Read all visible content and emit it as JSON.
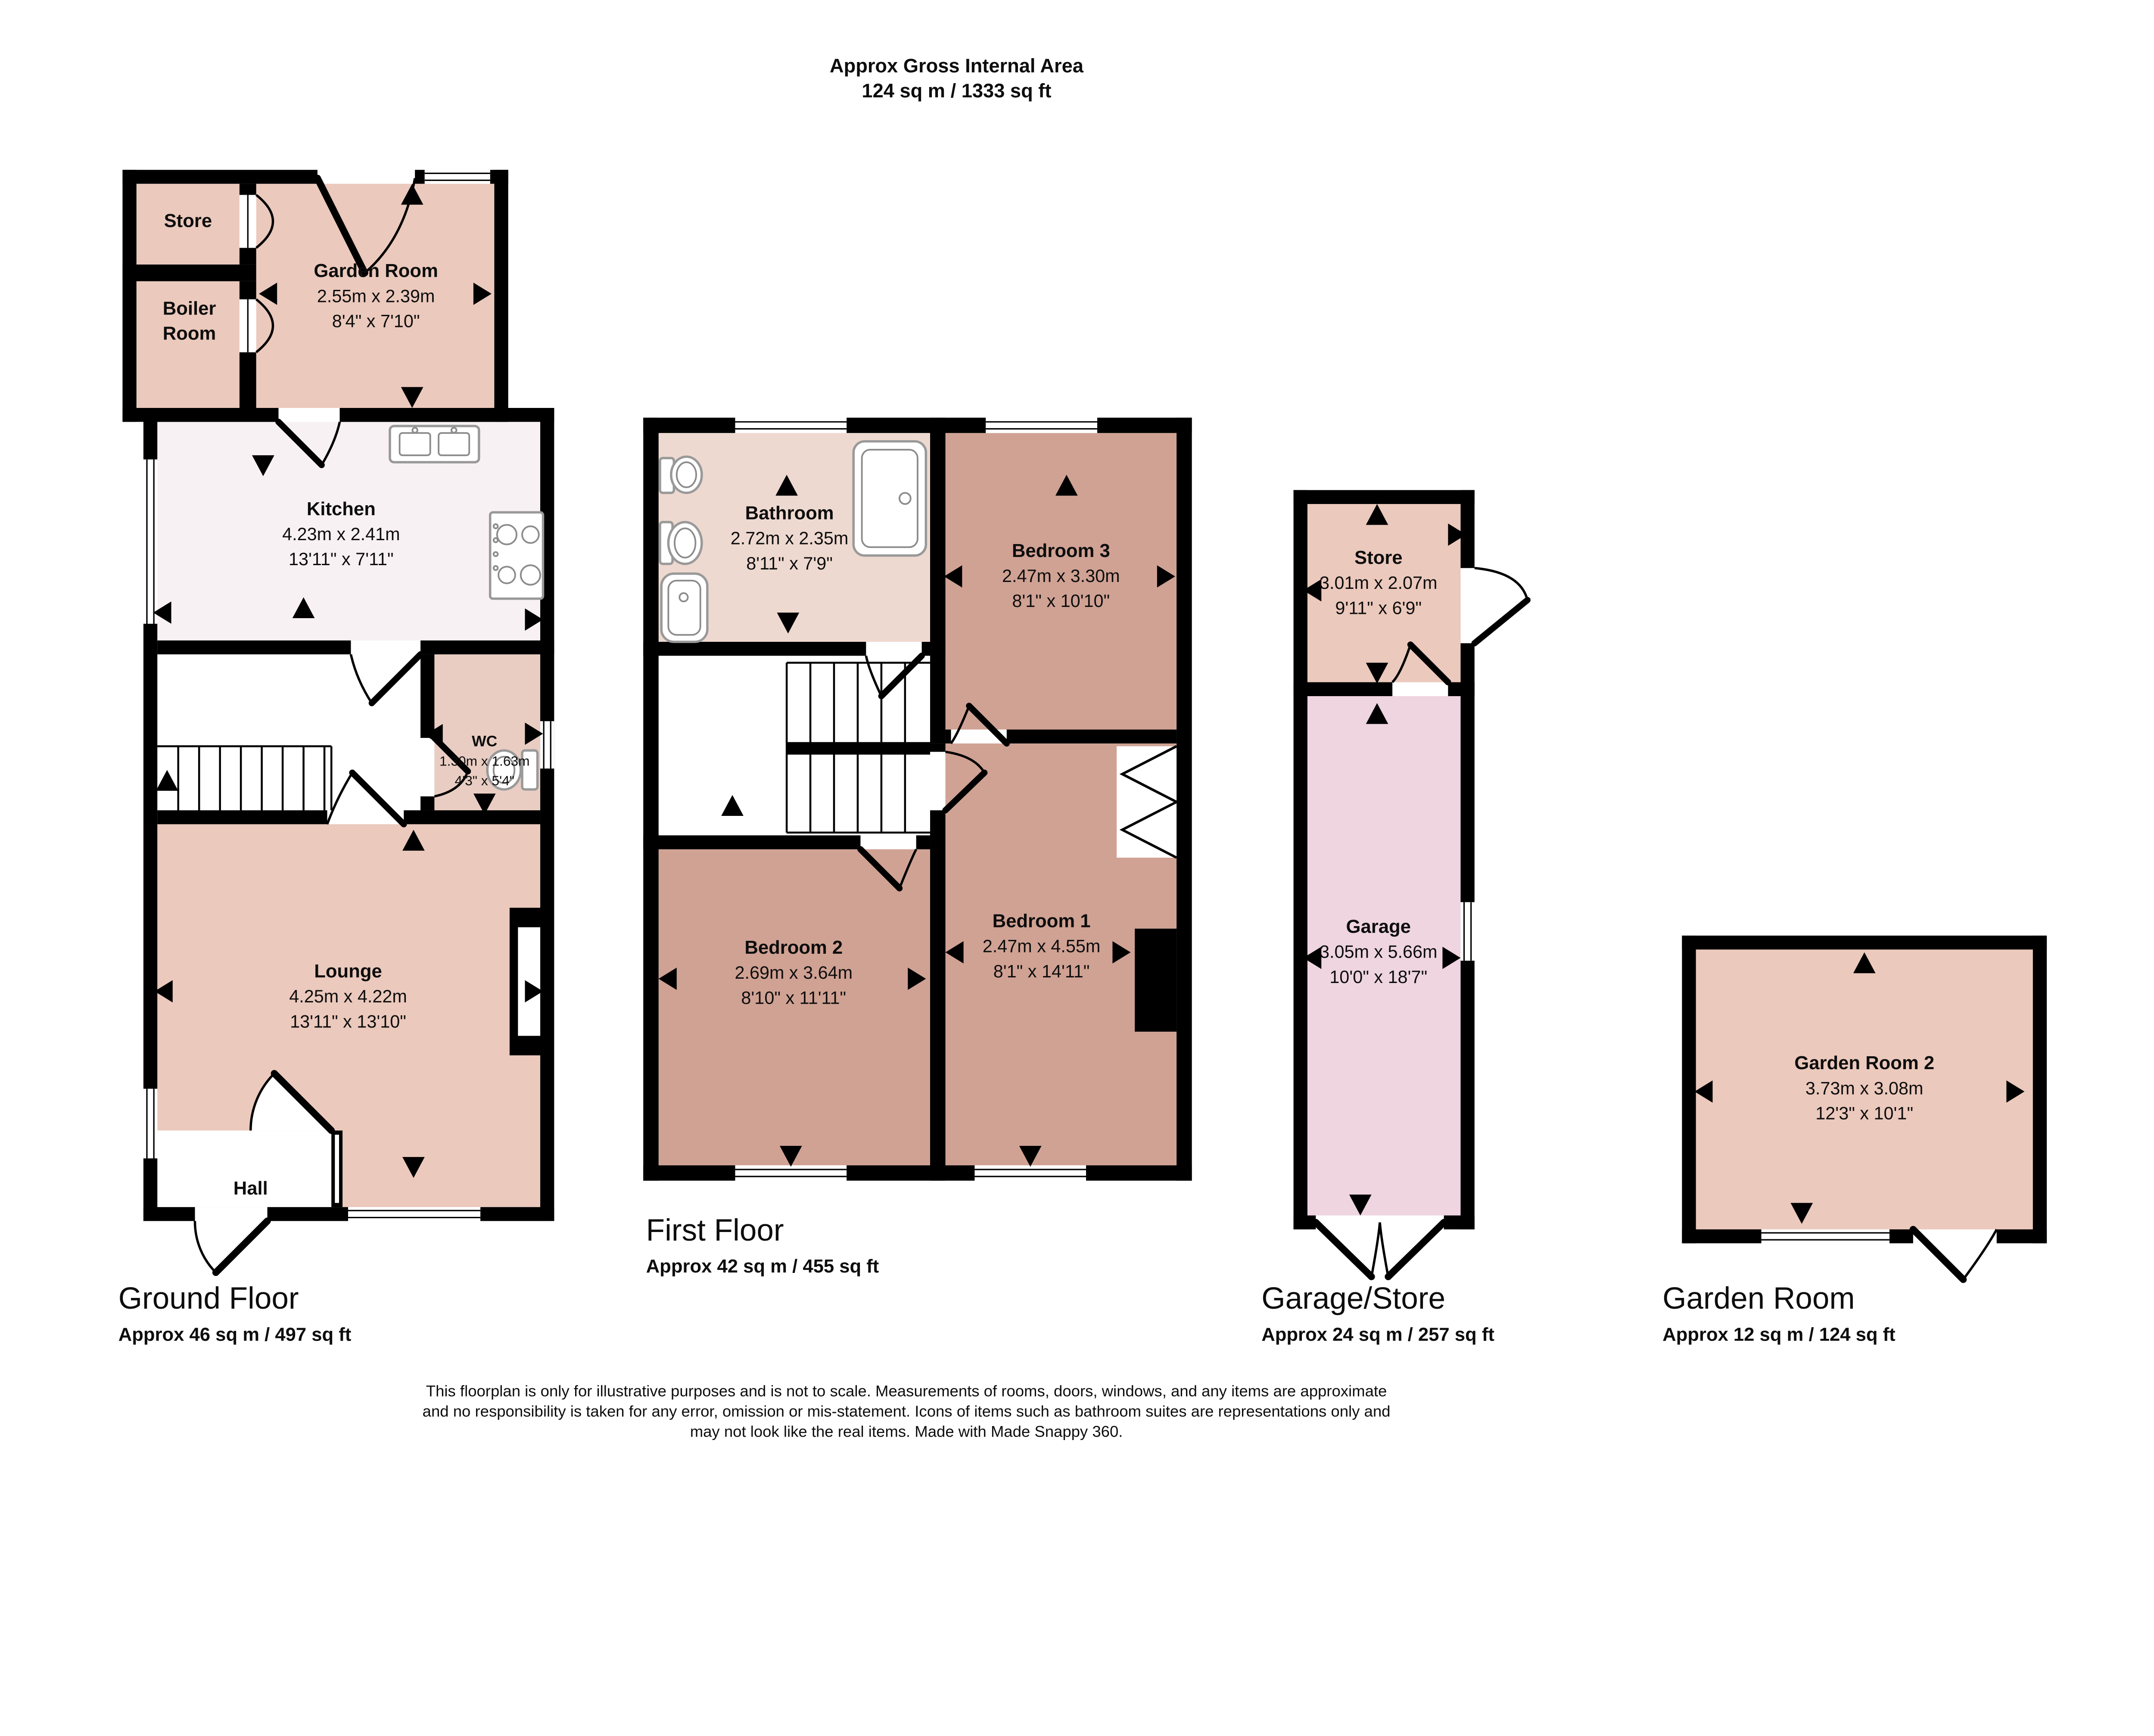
{
  "header": {
    "line1": "Approx Gross Internal Area",
    "line2": "124 sq m / 1333 sq ft"
  },
  "floors": {
    "ground": {
      "title": "Ground Floor",
      "area": "Approx 46 sq m / 497 sq ft",
      "rooms": {
        "store": {
          "name": "Store"
        },
        "boiler_room": {
          "line1": "Boiler",
          "line2": "Room"
        },
        "garden_room": {
          "name": "Garden Room",
          "metric": "2.55m x 2.39m",
          "imperial": "8'4\" x 7'10\""
        },
        "kitchen": {
          "name": "Kitchen",
          "metric": "4.23m x 2.41m",
          "imperial": "13'11\" x 7'11\""
        },
        "wc": {
          "name": "WC",
          "metric": "1.30m x 1.63m",
          "imperial": "4'3\" x 5'4\""
        },
        "lounge": {
          "name": "Lounge",
          "metric": "4.25m x 4.22m",
          "imperial": "13'11\" x 13'10\""
        },
        "hall": {
          "name": "Hall"
        }
      }
    },
    "first": {
      "title": "First Floor",
      "area": "Approx 42 sq m / 455 sq ft",
      "rooms": {
        "bathroom": {
          "name": "Bathroom",
          "metric": "2.72m x 2.35m",
          "imperial": "8'11\" x 7'9\""
        },
        "bedroom3": {
          "name": "Bedroom 3",
          "metric": "2.47m x 3.30m",
          "imperial": "8'1\" x 10'10\""
        },
        "bedroom2": {
          "name": "Bedroom 2",
          "metric": "2.69m x 3.64m",
          "imperial": "8'10\" x 11'11\""
        },
        "bedroom1": {
          "name": "Bedroom 1",
          "metric": "2.47m x 4.55m",
          "imperial": "8'1\" x 14'11\""
        }
      }
    },
    "garage": {
      "title": "Garage/Store",
      "area": "Approx 24 sq m / 257 sq ft",
      "rooms": {
        "store": {
          "name": "Store",
          "metric": "3.01m x 2.07m",
          "imperial": "9'11\" x 6'9\""
        },
        "garage": {
          "name": "Garage",
          "metric": "3.05m x 5.66m",
          "imperial": "10'0\" x 18'7\""
        }
      }
    },
    "garden": {
      "title": "Garden Room",
      "area": "Approx 12 sq m / 124 sq ft",
      "rooms": {
        "garden_room_2": {
          "name": "Garden Room 2",
          "metric": "3.73m x 3.08m",
          "imperial": "12'3\" x 10'1\""
        }
      }
    }
  },
  "footer": {
    "line1": "This floorplan is only for illustrative purposes and is not to scale. Measurements of rooms, doors, windows, and any items are approximate",
    "line2": "and no responsibility is taken for any error, omission or mis-statement. Icons of items such as bathroom suites are representations only and",
    "line3": "may not look like the real items. Made with Made Snappy 360."
  },
  "colors": {
    "salmon": "#ebc9bc",
    "kitchen": "#f8f1f4",
    "wc": "#e9cdc3",
    "bathroom": "#eed9d0",
    "bedroom": "#d0a294",
    "garage": "#eed5e0",
    "wall": "#000000"
  }
}
